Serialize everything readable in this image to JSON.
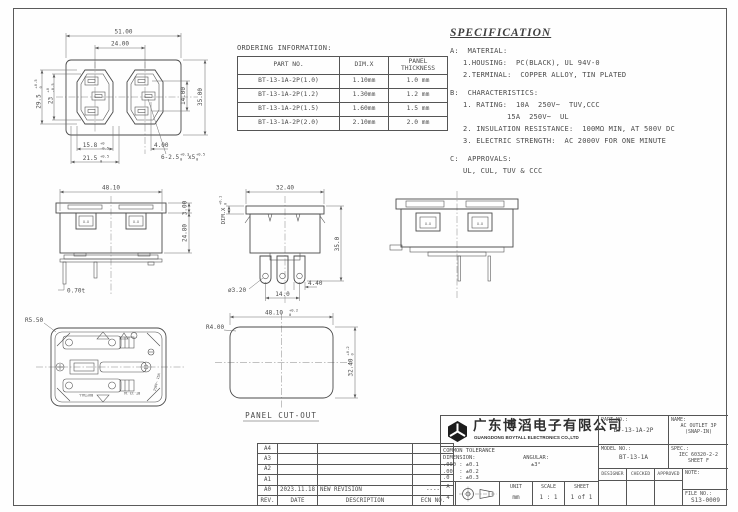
{
  "ordering": {
    "title": "ORDERING INFORMATION:",
    "col_part": "PART NO.",
    "col_dimx": "DIM.X",
    "col_panel1": "PANEL",
    "col_panel2": "THICKNESS",
    "rows": [
      [
        "BT-13-1A-2P(1.0)",
        "1.10mm",
        "1.0 mm"
      ],
      [
        "BT-13-1A-2P(1.2)",
        "1.30mm",
        "1.2 mm"
      ],
      [
        "BT-13-1A-2P(1.5)",
        "1.60mm",
        "1.5 mm"
      ],
      [
        "BT-13-1A-2P(2.0)",
        "2.10mm",
        "2.0 mm"
      ]
    ]
  },
  "spec": {
    "title": "SPECIFICATION",
    "a_head": "A:  MATERIAL:",
    "a1": "1.HOUSING:  PC(BLACK), UL 94V-0",
    "a2": "2.TERMINAL:  COPPER ALLOY, TIN PLATED",
    "b_head": "B:  CHARACTERISTICS:",
    "b1": "1. RATING:  10A  250V~  TUV,CCC",
    "b1b": "15A  250V~  UL",
    "b2": "2. INSULATION RESISTANCE:  100MΩ MIN, AT 500V DC",
    "b3": "3. ELECTRIC STRENGTH:  AC 2000V FOR ONE MINUTE",
    "c_head": "C:  APPROVALS:",
    "c1": "UL, CUL, TUV & CCC"
  },
  "front": {
    "dim_w": "51.00",
    "dim_centers": "24.00",
    "dim_h": "35.00",
    "dim_pins": "14.00",
    "dim_left_outer": "29.5",
    "tol_left_outer_up": "+0.5",
    "tol_left_outer_dn": "0",
    "dim_left_inner": "23",
    "tol_left_inner_up": "+0",
    "tol_left_inner_dn": "-0.5",
    "dim_bot_inner": "15.8",
    "tol_bot_inner_up": "+0",
    "tol_bot_inner_dn": "-0.5",
    "dim_bot_outer": "21.5",
    "tol_bot_outer_up": "+0.5",
    "tol_bot_outer_dn": "0",
    "dim_pin_offset": "4.00",
    "slot_note": "6-2.5",
    "slot_tol_up": "+0.3",
    "slot_tol_dn": "0",
    "slot_x": "x5",
    "slot_x_tol_up": "+0.5",
    "slot_x_tol_dn": "0"
  },
  "side": {
    "dim_w": "48.10",
    "dim_flange": "3.00",
    "dim_body": "24.80",
    "dim_t": "0.70t",
    "mark": "X.X"
  },
  "center": {
    "dim_label": "DIM.X",
    "dim_label_tol_up": "+0.1",
    "dim_label_tol_dn": "0",
    "dim_w": "32.40",
    "dim_h": "35.0",
    "dim_pin_d": "ø3.20",
    "dim_pitch": "14.0",
    "dim_pin_w": "4.40"
  },
  "rear": {
    "mark": "X.X"
  },
  "back": {
    "dim_r": "R5.50",
    "brand": "BOYTALL",
    "model": "BT-13-1A",
    "rating": "250V~ 15A"
  },
  "cutout": {
    "label": "PANEL CUT-OUT",
    "dim_w": "48.10",
    "tol_w_up": "+0.2",
    "tol_w_dn": "0",
    "dim_h": "32.40",
    "tol_h_up": "+0.2",
    "tol_h_dn": "0",
    "dim_r": "R4.00"
  },
  "revision": {
    "rows": [
      {
        "rev": "A4",
        "date": "",
        "desc": "",
        "ecn": ""
      },
      {
        "rev": "A3",
        "date": "",
        "desc": "",
        "ecn": ""
      },
      {
        "rev": "A2",
        "date": "",
        "desc": "",
        "ecn": ""
      },
      {
        "rev": "A1",
        "date": "",
        "desc": "",
        "ecn": ""
      },
      {
        "rev": "A0",
        "date": "2023.11.18",
        "desc": "NEW REVISION",
        "ecn": "----"
      }
    ],
    "footer": {
      "rev": "REV.",
      "date": "DATE",
      "desc": "DESCRIPTION",
      "ecn": "ECN NO."
    }
  },
  "titleblock": {
    "company_cn": "广东博滔电子有限公司",
    "company_en": "GUANGDONG BOYTALL ELECTRONICS CO.,LTD",
    "tolerance_title": "COMMON TOLERANCE",
    "dimension_label": "DIMENSION:",
    "angular_label": "ANGULAR:",
    "tol1": ".000 : ±0.1",
    "tol2": ".00  : ±0.2",
    "tol3": ".0   : ±0.3",
    "angular_value": "±3°",
    "paper_a": "A",
    "paper_4": "4",
    "unit_label": "UNIT",
    "unit_value": "mm",
    "scale_label": "SCALE",
    "scale_value": "1 : 1",
    "sheet_label": "SHEET",
    "sheet_value": "1 of 1",
    "part_label": "PART NO.:",
    "part_value": "BT-13-1A-2P",
    "name_label": "NAME:",
    "name_value1": "AC OUTLET 3P",
    "name_value2": "(SNAP-IN)",
    "model_label": "MODEL NO.:",
    "model_value": "BT-13-1A",
    "spec_label": "SPEC.:",
    "spec_value1": "IEC 60320-2-2",
    "spec_value2": "SHEET F",
    "designer_label": "DESIGNER",
    "checked_label": "CHECKED",
    "approved_label": "APPROVED",
    "note_label": "NOTE:",
    "file_label": "FILE NO.:",
    "file_value": "S13-0009"
  }
}
